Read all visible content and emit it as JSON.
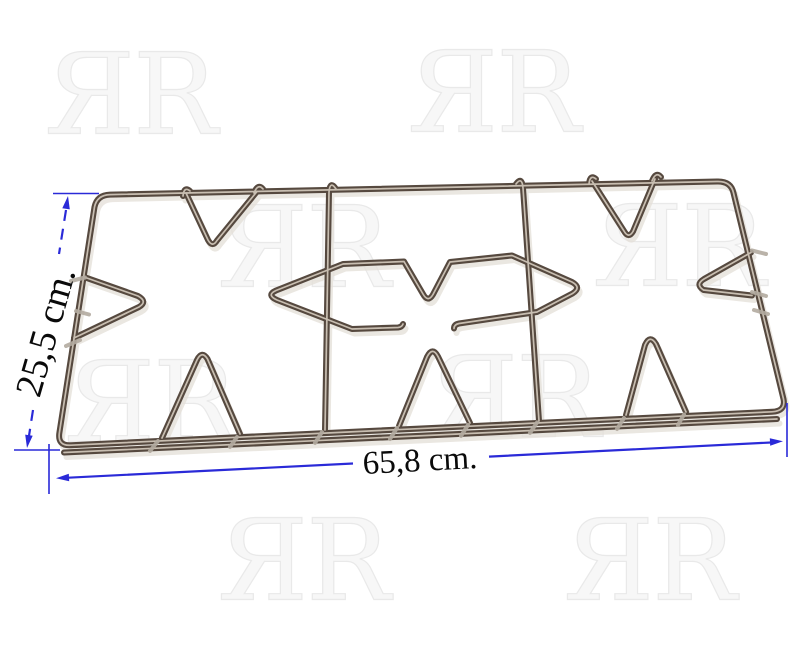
{
  "watermark": {
    "text": "ЯR"
  },
  "dimensions": {
    "height_label": "25,5 cm.",
    "width_label": "65,8 cm."
  },
  "colors": {
    "background": "#ffffff",
    "dimension_blue": "#2a2ad8",
    "label_text": "#0a0a0a",
    "wire_dark": "#56493f",
    "wire_highlight": "#cfc5b8",
    "wire_shadow": "#e4dfd8",
    "nub_light": "#b3aba0",
    "watermark_outline": "#e9e9e9"
  }
}
